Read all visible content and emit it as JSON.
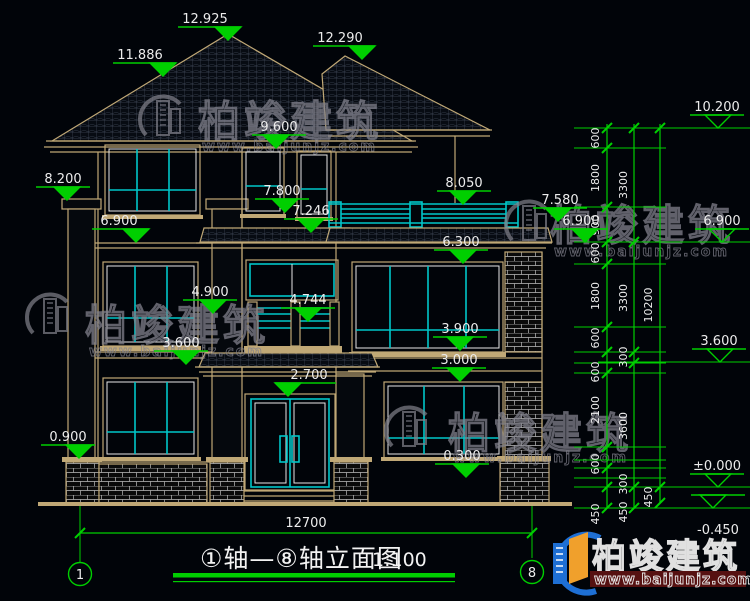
{
  "drawing": {
    "colors": {
      "background": "#010409",
      "line_tan": "#c0a876",
      "line_cyan": "#00c6c9",
      "line_white": "#e6e6e6",
      "dim_green": "#00cf00",
      "text_white": "#ececec",
      "roof_grid": "#3d4554",
      "brick_mortar": "#bdbdbd",
      "watermark_gray": "#81818c",
      "logo_blue": "#1e6fd4",
      "logo_orange": "#f0a02c",
      "logo_red": "#561111"
    },
    "title": {
      "text": "①轴—⑧轴立面图",
      "scale": "1:100"
    },
    "axis_bubbles": [
      {
        "label": "1",
        "cx": 80,
        "cy": 574
      },
      {
        "label": "8",
        "cx": 532,
        "cy": 572
      }
    ],
    "overall_width_dim": {
      "label": "12700",
      "x1": 80,
      "x2": 532,
      "y": 533,
      "textX": 306,
      "textY": 527
    },
    "elevation_markers": [
      {
        "label": "12.925",
        "tx": 205,
        "tipX": 228,
        "tipY": 40,
        "filled": true
      },
      {
        "label": "11.886",
        "tx": 140,
        "tipX": 163,
        "tipY": 76,
        "filled": true
      },
      {
        "label": "12.290",
        "tx": 340,
        "tipX": 362,
        "tipY": 59,
        "filled": true
      },
      {
        "label": "9.600",
        "tx": 279,
        "tipX": 276,
        "tipY": 148,
        "filled": true
      },
      {
        "label": "8.200",
        "tx": 63,
        "tipX": 67,
        "tipY": 200,
        "filled": true
      },
      {
        "label": "7.800",
        "tx": 282,
        "tipX": 285,
        "tipY": 212,
        "filled": true
      },
      {
        "label": "7.246",
        "tx": 311,
        "tipX": 311,
        "tipY": 232,
        "filled": true
      },
      {
        "label": "8.050",
        "tx": 464,
        "tipX": 463,
        "tipY": 204,
        "filled": true
      },
      {
        "label": "7.580",
        "tx": 560,
        "tipX": 558,
        "tipY": 221,
        "filled": true
      },
      {
        "label": "6.900",
        "tx": 119,
        "tipX": 136,
        "tipY": 242,
        "filled": true
      },
      {
        "label": "6.900",
        "tx": 581,
        "tipX": 585,
        "tipY": 242,
        "filled": true
      },
      {
        "label": "6.300",
        "tx": 461,
        "tipX": 463,
        "tipY": 263,
        "filled": true
      },
      {
        "label": "4.900",
        "tx": 210,
        "tipX": 213,
        "tipY": 313,
        "filled": true
      },
      {
        "label": "4.744",
        "tx": 308,
        "tipX": 308,
        "tipY": 321,
        "filled": true
      },
      {
        "label": "3.900",
        "tx": 460,
        "tipX": 460,
        "tipY": 350,
        "filled": true
      },
      {
        "label": "3.600",
        "tx": 181,
        "tipX": 186,
        "tipY": 364,
        "filled": true
      },
      {
        "label": "3.000",
        "tx": 459,
        "tipX": 460,
        "tipY": 381,
        "filled": true
      },
      {
        "label": "2.700",
        "tx": 309,
        "tipX": 288,
        "tipY": 396,
        "filled": true
      },
      {
        "label": "0.900",
        "tx": 68,
        "tipX": 79,
        "tipY": 458,
        "filled": true
      },
      {
        "label": "0.300",
        "tx": 462,
        "tipX": 466,
        "tipY": 477,
        "filled": true
      },
      {
        "label": "10.200",
        "tx": 717,
        "tipX": 718,
        "tipY": 128,
        "filled": false
      },
      {
        "label": "6.900",
        "tx": 722,
        "tipX": 722,
        "tipY": 242,
        "filled": false
      },
      {
        "label": "3.600",
        "tx": 719,
        "tipX": 720,
        "tipY": 362,
        "filled": false
      },
      {
        "label": "±0.000",
        "tx": 717,
        "tipX": 718,
        "tipY": 487,
        "filled": false
      },
      {
        "label": "-0.450",
        "tx": 718,
        "tipX": 713,
        "tipY": 508,
        "filled": false,
        "flip": true
      }
    ],
    "dim_chain": {
      "verticals": [
        {
          "x": 607,
          "y1": 124,
          "y2": 509
        },
        {
          "x": 634,
          "y1": 124,
          "y2": 509
        },
        {
          "x": 660,
          "y1": 124,
          "y2": 503
        }
      ],
      "connectors_short": [
        128,
        148,
        207,
        242,
        264,
        327,
        352,
        363,
        373,
        447,
        460,
        468,
        478,
        487,
        508
      ],
      "connectors_long": [
        128,
        242,
        362,
        487,
        508
      ],
      "ticks": [
        {
          "x": 607,
          "ys": [
            128,
            148,
            207,
            242,
            264,
            327,
            352,
            373,
            447,
            468,
            487,
            508
          ]
        },
        {
          "x": 634,
          "ys": [
            128,
            242,
            352,
            363,
            487,
            508
          ]
        },
        {
          "x": 660,
          "ys": [
            128,
            487,
            503
          ]
        }
      ],
      "labels": [
        {
          "v": "600",
          "x": 599,
          "y": 138
        },
        {
          "v": "1800",
          "x": 599,
          "y": 178
        },
        {
          "v": "900",
          "x": 599,
          "y": 225
        },
        {
          "v": "600",
          "x": 599,
          "y": 253
        },
        {
          "v": "1800",
          "x": 599,
          "y": 296
        },
        {
          "v": "600",
          "x": 599,
          "y": 338
        },
        {
          "v": "600",
          "x": 599,
          "y": 372
        },
        {
          "v": "2100",
          "x": 599,
          "y": 410
        },
        {
          "v": "600",
          "x": 599,
          "y": 464
        },
        {
          "v": "450",
          "x": 599,
          "y": 514
        },
        {
          "v": "3300",
          "x": 627,
          "y": 185
        },
        {
          "v": "3300",
          "x": 627,
          "y": 298
        },
        {
          "v": "300",
          "x": 627,
          "y": 357
        },
        {
          "v": "3600",
          "x": 627,
          "y": 426
        },
        {
          "v": "300",
          "x": 627,
          "y": 484
        },
        {
          "v": "450",
          "x": 627,
          "y": 512
        },
        {
          "v": "10200",
          "x": 652,
          "y": 305
        },
        {
          "v": "450",
          "x": 652,
          "y": 497
        }
      ]
    },
    "watermark": {
      "brand": "柏竣建筑",
      "site": "www.baijunjz.com"
    },
    "watermarks": [
      {
        "iconX": 140,
        "iconY": 95,
        "charX": 198,
        "charY": 136,
        "charSize": 42,
        "wwwX": 202,
        "wwwY": 151,
        "wwwSize": 14
      },
      {
        "iconX": 506,
        "iconY": 200,
        "charX": 550,
        "charY": 240,
        "charSize": 42,
        "wwwX": 554,
        "wwwY": 256,
        "wwwSize": 14
      },
      {
        "iconX": 27,
        "iconY": 293,
        "charX": 85,
        "charY": 340,
        "charSize": 42,
        "wwwX": 89,
        "wwwY": 356,
        "wwwSize": 14
      },
      {
        "iconX": 386,
        "iconY": 406,
        "charX": 448,
        "charY": 448,
        "charSize": 42,
        "wwwX": 453,
        "wwwY": 462,
        "wwwSize": 14
      }
    ],
    "logo": {
      "brand": "柏竣建筑",
      "site": "www.baijunjz.com"
    }
  }
}
